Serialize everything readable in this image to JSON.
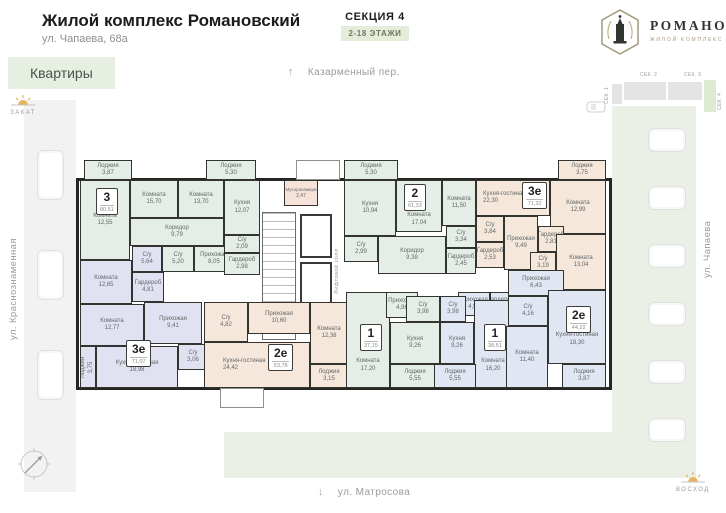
{
  "palette": {
    "accent_green": "#e7efe2",
    "mint": "#e4ede6",
    "lavender": "#e1e2f1",
    "beige": "#f5e7da",
    "blue": "#e0e7f3",
    "wall": "#262624",
    "lawn": "#eaf0e5"
  },
  "header": {
    "title": "Жилой комплекс Романовский",
    "address": "ул. Чапаева, 68а",
    "section": "СЕКЦИЯ 4",
    "floors": "2-18 ЭТАЖИ",
    "apartments_button": "Квартиры",
    "logo_name": "РОМАНОВСКИЙ",
    "logo_subtitle": "ЖИЛОЙ КОМПЛЕКС"
  },
  "minimap": {
    "sec1": "СЕК. 1",
    "sec2": "СЕК. 2",
    "sec3": "СЕК. 3",
    "sec4": "СЕК. 4"
  },
  "streets": {
    "top": "Казарменный пер.",
    "left": "ул. Краснознаменная",
    "right": "ул. Чапаева",
    "bottom": "ул. Матросова"
  },
  "markers": {
    "sunset": "ЗАКАТ",
    "sunrise": "ВОСХОД"
  },
  "core": {
    "elevator_hall": "Лифтовой холл",
    "service_room": {
      "name": "Мусорокамера",
      "area": "2,47"
    }
  },
  "apartments": [
    {
      "id": "apt-3",
      "label": "3",
      "area": "80,51",
      "rooms": [
        {
          "name": "Лоджия",
          "area": "3,87"
        },
        {
          "name": "Комната",
          "area": "12,55"
        },
        {
          "name": "Комната",
          "area": "15,70"
        },
        {
          "name": "Комната",
          "area": "13,70"
        },
        {
          "name": "Лоджия",
          "area": "5,30"
        },
        {
          "name": "Кухня",
          "area": "12,07"
        },
        {
          "name": "Коридор",
          "area": "9,79"
        },
        {
          "name": "С/у",
          "area": "5,20"
        },
        {
          "name": "Прихожая",
          "area": "8,05"
        },
        {
          "name": "С/у",
          "area": "2,09"
        },
        {
          "name": "Гардероб",
          "area": "2,98"
        }
      ]
    },
    {
      "id": "apt-3e-left",
      "label": "3е",
      "area": "71,07",
      "rooms": [
        {
          "name": "Комната",
          "area": "12,65"
        },
        {
          "name": "С/у",
          "area": "5,64"
        },
        {
          "name": "Гардероб",
          "area": "4,81"
        },
        {
          "name": "Комната",
          "area": "12,77"
        },
        {
          "name": "Прихожая",
          "area": "9,41"
        },
        {
          "name": "С/у",
          "area": "3,06"
        },
        {
          "name": "Кухня-гостиная",
          "area": "18,98"
        },
        {
          "name": "Лоджия",
          "area": "3,75"
        }
      ]
    },
    {
      "id": "apt-2",
      "label": "2",
      "area": "61,33",
      "rooms": [
        {
          "name": "Лоджия",
          "area": "5,30"
        },
        {
          "name": "Кухня",
          "area": "10,94"
        },
        {
          "name": "Комната",
          "area": "17,04"
        },
        {
          "name": "Комната",
          "area": "11,50"
        },
        {
          "name": "С/у",
          "area": "2,99"
        },
        {
          "name": "С/у",
          "area": "3,34"
        },
        {
          "name": "Гардероб",
          "area": "2,45"
        },
        {
          "name": "Коридор",
          "area": "9,38"
        }
      ]
    },
    {
      "id": "apt-3e-right",
      "label": "3е",
      "area": "71,32",
      "rooms": [
        {
          "name": "Кухня-гостиная",
          "area": "22,30"
        },
        {
          "name": "Лоджия",
          "area": "3,75"
        },
        {
          "name": "Комната",
          "area": "12,99"
        },
        {
          "name": "С/у",
          "area": "3,84"
        },
        {
          "name": "Гардероб",
          "area": "2,53"
        },
        {
          "name": "Прихожая",
          "area": "9,49"
        },
        {
          "name": "Гардероб",
          "area": "2,81"
        },
        {
          "name": "С/у",
          "area": "3,19"
        },
        {
          "name": "Комната",
          "area": "13,04"
        }
      ]
    },
    {
      "id": "apt-2e-mid",
      "label": "2е",
      "area": "53,78",
      "rooms": [
        {
          "name": "С/у",
          "area": "4,82"
        },
        {
          "name": "Прихожая",
          "area": "10,60"
        },
        {
          "name": "Кухня-гостиная",
          "area": "24,42"
        },
        {
          "name": "Комната",
          "area": "12,38"
        },
        {
          "name": "Лоджия",
          "area": "3,15"
        }
      ]
    },
    {
      "id": "apt-1-left",
      "label": "1",
      "area": "37,15",
      "rooms": [
        {
          "name": "Комната",
          "area": "17,20"
        },
        {
          "name": "Прихожая",
          "area": "4,96"
        },
        {
          "name": "С/у",
          "area": "3,98"
        },
        {
          "name": "Кухня",
          "area": "9,26"
        },
        {
          "name": "Лоджия",
          "area": "5,55"
        }
      ]
    },
    {
      "id": "apt-1-right",
      "label": "1",
      "area": "38,51",
      "rooms": [
        {
          "name": "Гардероб",
          "area": "2,41"
        },
        {
          "name": "Прихожая",
          "area": "4,99"
        },
        {
          "name": "С/у",
          "area": "3,98"
        },
        {
          "name": "Кухня",
          "area": "9,26"
        },
        {
          "name": "Комната",
          "area": "16,20"
        },
        {
          "name": "Лоджия",
          "area": "5,55"
        }
      ]
    },
    {
      "id": "apt-2e-right",
      "label": "2е",
      "area": "44,22",
      "rooms": [
        {
          "name": "Прихожая",
          "area": "6,43"
        },
        {
          "name": "С/у",
          "area": "4,16"
        },
        {
          "name": "Кухня-гостиная",
          "area": "18,30"
        },
        {
          "name": "Комната",
          "area": "11,40"
        },
        {
          "name": "Лоджия",
          "area": "3,87"
        }
      ]
    }
  ]
}
